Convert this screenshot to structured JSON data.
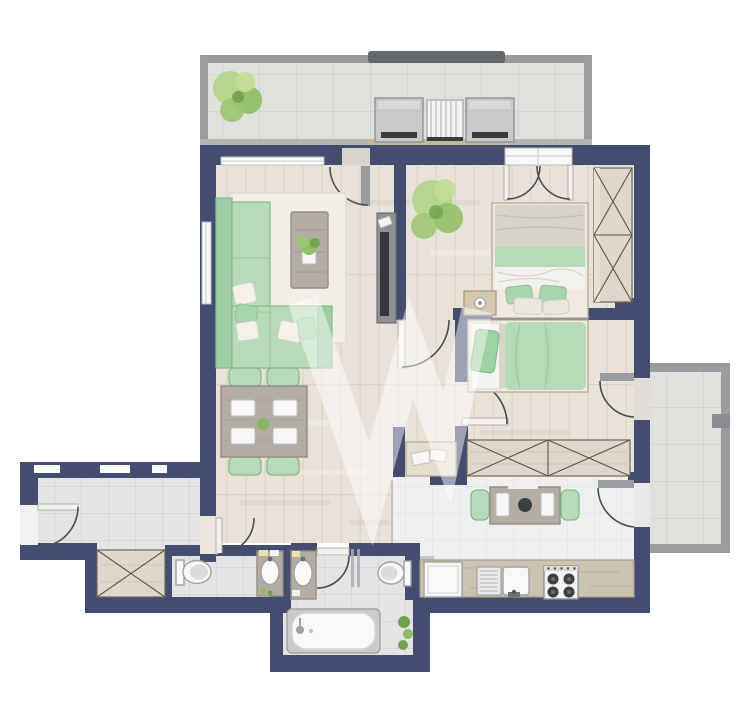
{
  "palette": {
    "wall": "#434d6f",
    "wood_floor": "#e8e2d8",
    "wood_line": "#d8d0c4",
    "tile_floor": "#e3e4e3",
    "tile_line": "#d0d2d1",
    "kitchen_tile": "#eef0ef",
    "kitchen_tile_line": "#e0e3e1",
    "balcony_tile": "#dfe1dd",
    "balcony_tile_line": "#cbcecb",
    "railing": "#9a9c9e",
    "railing_dark": "#65686a",
    "mint": "#b7dbb9",
    "mint_dark": "#a0cea4",
    "mint_border": "#85bb8b",
    "rug": "#f1eee6",
    "gray_wood": "#b3ada4",
    "wardrobe_wood": "#ded7cb",
    "fixture_white": "#f7f8f8",
    "fixture_stroke": "#9fa2a3",
    "tv_screen": "#33373a",
    "plant_green": "#8fbd60",
    "plant_light": "#b3d489",
    "plant_dark": "#6fa14e",
    "counter_wood": "#cbc2b1",
    "linen_gray": "#d8d4ca",
    "bed_frame": "#efe9df",
    "threshold_wood": "#c9b79b",
    "watermark": "#ffffff"
  },
  "watermark": {
    "name": "brand-watermark",
    "color": "#ffffff",
    "opacity": 0.48
  },
  "plan": {
    "rooms": [
      {
        "name": "top-balcony",
        "floor": "tile",
        "items": [
          "plant",
          "lounge-chair",
          "slat-table",
          "lounge-chair"
        ]
      },
      {
        "name": "living-dining-room",
        "floor": "wood",
        "items": [
          "corner-sofa",
          "rug",
          "coffee-table",
          "tv-sideboard",
          "dining-table",
          "dining-chairs",
          "plates"
        ]
      },
      {
        "name": "bedroom-1",
        "floor": "wood",
        "items": [
          "double-bed",
          "nightstand",
          "wardrobe",
          "plant"
        ]
      },
      {
        "name": "bedroom-2",
        "floor": "wood",
        "items": [
          "single-bed",
          "built-in-wardrobe",
          "console-shelf"
        ]
      },
      {
        "name": "entrance-hall",
        "floor": "tile",
        "items": [
          "entry-door"
        ]
      },
      {
        "name": "closet",
        "floor": "wood",
        "items": [
          "built-in-closet"
        ]
      },
      {
        "name": "wc",
        "floor": "tile",
        "items": [
          "toilet",
          "vanity-sink"
        ]
      },
      {
        "name": "bathroom",
        "floor": "tile",
        "items": [
          "vanity-sink",
          "toilet",
          "bathtub",
          "glass-partition",
          "plant"
        ]
      },
      {
        "name": "kitchen",
        "floor": "tile",
        "items": [
          "kitchen-table",
          "chairs",
          "counter",
          "washing-machine",
          "sink",
          "stove"
        ]
      },
      {
        "name": "side-balcony",
        "floor": "tile",
        "items": []
      }
    ],
    "doors": [
      "living-balcony-door",
      "bedroom1-french-doors",
      "bedroom1-door",
      "bedroom2-door",
      "bedroom2-balcony-door",
      "kitchen-balcony-door",
      "bathroom-door",
      "entry-door",
      "hall-door"
    ]
  }
}
